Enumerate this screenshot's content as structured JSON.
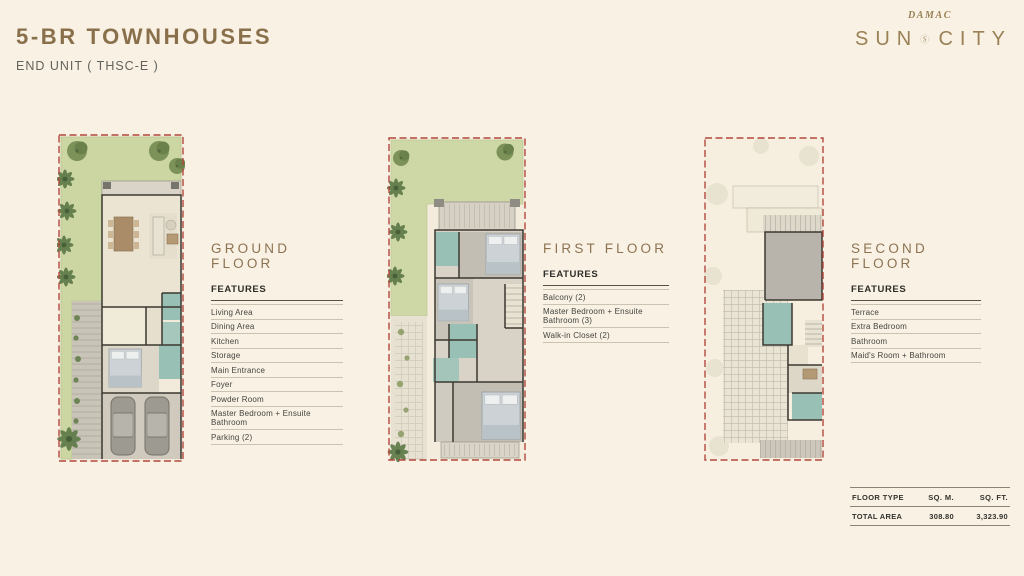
{
  "palette": {
    "background": "#f8f1e4",
    "accent_gold": "#8d7352",
    "text_dark": "#33322d",
    "boundary_red": "#b4483d",
    "garden_green": "#ccd6a3",
    "bathroom_teal": "#98c0b4"
  },
  "header": {
    "title": "5-BR TOWNHOUSES",
    "subtitle": "END UNIT ( THSC-E )",
    "brand_name": "DAMAC",
    "logo_word_left": "SUN",
    "logo_monogram": "S",
    "logo_word_right": "CITY"
  },
  "sections": [
    {
      "heading": "GROUND FLOOR",
      "features_label": "FEATURES",
      "features": [
        "Living Area",
        "Dining Area",
        "Kitchen",
        "Storage",
        "Main Entrance",
        "Foyer",
        "Powder Room",
        "Master Bedroom + Ensuite Bathroom",
        "Parking (2)"
      ]
    },
    {
      "heading": "FIRST FLOOR",
      "features_label": "FEATURES",
      "features": [
        "Balcony (2)",
        "Master Bedroom + Ensuite Bathroom (3)",
        "Walk-in Closet (2)"
      ]
    },
    {
      "heading": "SECOND FLOOR",
      "features_label": "FEATURES",
      "features": [
        "Terrace",
        "Extra Bedroom",
        "Bathroom",
        "Maid's Room + Bathroom"
      ]
    }
  ],
  "area_table": {
    "col_floor_type": "FLOOR TYPE",
    "col_sqm": "SQ. M.",
    "col_sqft": "SQ. FT.",
    "row_label": "TOTAL AREA",
    "row_sqm": "308.80",
    "row_sqft": "3,323.90"
  }
}
